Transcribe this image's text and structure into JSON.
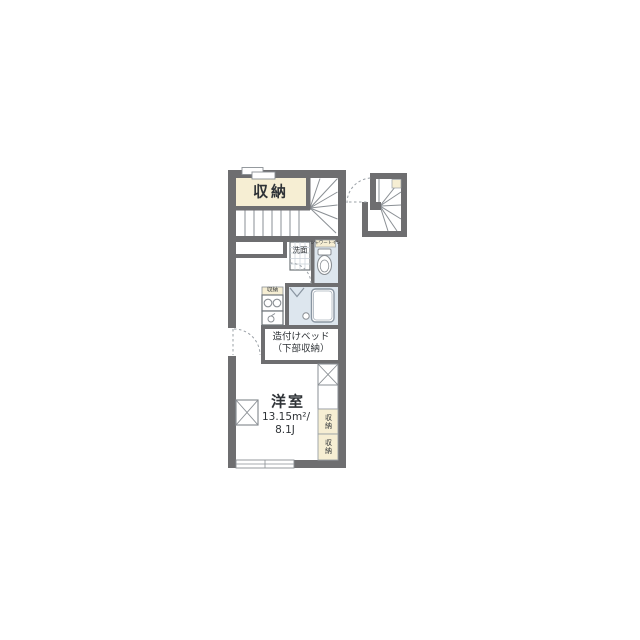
{
  "plan": {
    "closet_label": "収納",
    "washroom_label": "洗面",
    "toilet_label": "シャワートイレ",
    "kitchen_storage_label": "収納",
    "bed_line1": "造付けベッド",
    "bed_line2": "（下部収納）",
    "room_label": "洋室",
    "room_area": "13.15m²/",
    "room_tatami": "8.1J",
    "right_storage_1": "収納",
    "right_storage_2": "収納"
  },
  "colors": {
    "wall": "#6e6e70",
    "closet_fill": "#f6eed3",
    "water_fill": "#dde6ee",
    "line": "#8a8f94",
    "text": "#2f3337",
    "background": "#ffffff"
  }
}
